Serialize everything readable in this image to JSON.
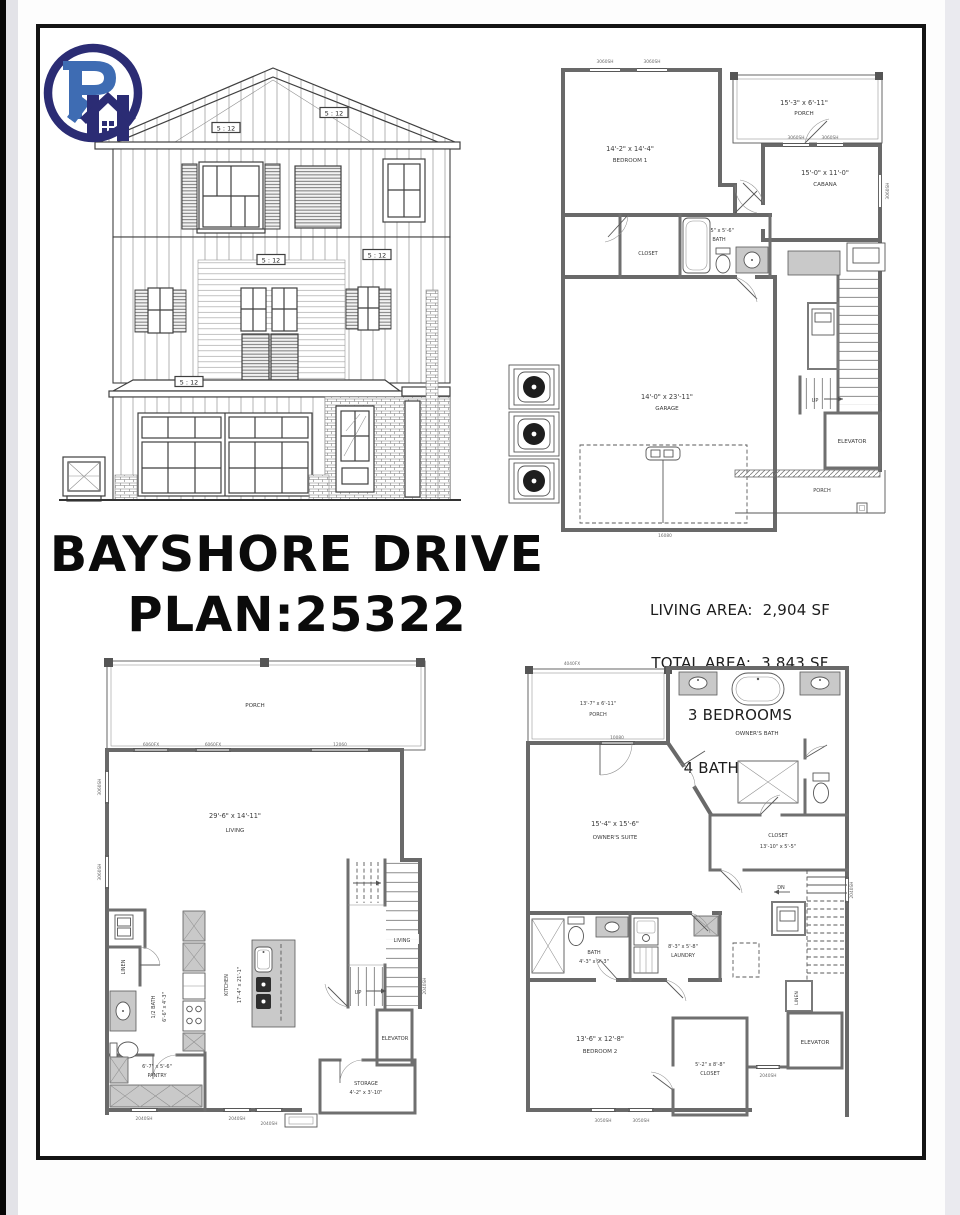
{
  "title": {
    "line1": "BAYSHORE DRIVE",
    "line2": "PLAN:25322"
  },
  "summary": {
    "living_area": "LIVING AREA:  2,904 SF",
    "total_area": "TOTAL AREA:  3,843 SF",
    "bedrooms": "3 BEDROOMS",
    "bathrooms": "4 BATHROOMS"
  },
  "elevation": {
    "pitch": "5 : 12"
  },
  "first_floor": {
    "rooms": {
      "bedroom1_dims": "14'-2\" x 14'-4\"",
      "bedroom1": "BEDROOM 1",
      "porch_upper_dims": "15'-3\" x 6'-11\"",
      "porch_upper": "PORCH",
      "cabana_dims": "15'-0\" x 11'-0\"",
      "cabana": "CABANA",
      "closet": "CLOSET",
      "bath_dims": "8'-5\" x 5'-6\"",
      "bath": "BATH",
      "garage_dims": "14'-0\" x 23'-11\"",
      "garage": "GARAGE",
      "up": "UP",
      "elevator": "ELEVATOR",
      "porch_lower": "PORCH"
    },
    "windows": {
      "w1": "3060SH",
      "w2": "3060SH",
      "w3": "3060SH",
      "w4": "3060SH",
      "w5": "3060SH",
      "garage_door": "16080"
    }
  },
  "second_floor": {
    "rooms": {
      "porch": "PORCH",
      "living_dims": "29'-6\" x 14'-11\"",
      "living": "LIVING",
      "linen": "LINEN",
      "half_bath": "1/2 BATH",
      "half_bath_dims": "6'-6\" x 4'-3\"",
      "kitchen": "KITCHEN",
      "kitchen_dims": "17'-4\" x 21'-1\"",
      "pantry_dims": "6'-7\" x 5'-6\"",
      "pantry": "PANTRY",
      "living_small": "LIVING",
      "up": "UP",
      "elevator": "ELEVATOR",
      "storage": "STORAGE",
      "storage_dims": "4'-2\" x 3'-10\""
    },
    "windows": {
      "a": "6060FX",
      "b": "6060FX",
      "c": "12060",
      "d": "3060SH",
      "e": "3060SH",
      "f": "2040SH",
      "g": "2040SH",
      "h": "2040SH",
      "i": "2040SH"
    }
  },
  "third_floor": {
    "rooms": {
      "porch_dims": "13'-7\" x 6'-11\"",
      "porch": "PORCH",
      "owners_bath": "OWNER'S BATH",
      "owners_suite_dims": "15'-4\" x 15'-6\"",
      "owners_suite": "OWNER'S SUITE",
      "closet": "CLOSET",
      "closet_dims": "13'-10\" x 5'-5\"",
      "bath": "BATH",
      "bath_dims": "4'-3\" x 9'-3\"",
      "laundry_dims": "8'-3\" x 5'-8\"",
      "laundry": "LAUNDRY",
      "bedroom2_dims": "13'-6\" x 12'-8\"",
      "bedroom2": "BEDROOM 2",
      "closet2_dims": "5'-2\" x 8'-8\"",
      "closet2": "CLOSET",
      "dn": "DN",
      "linen": "LINEN",
      "elevator": "ELEVATOR"
    },
    "windows": {
      "a": "4040FX",
      "b": "2040SH",
      "c": "2040SH",
      "d": "3050SH",
      "e": "3050SH",
      "f": "10080"
    }
  }
}
